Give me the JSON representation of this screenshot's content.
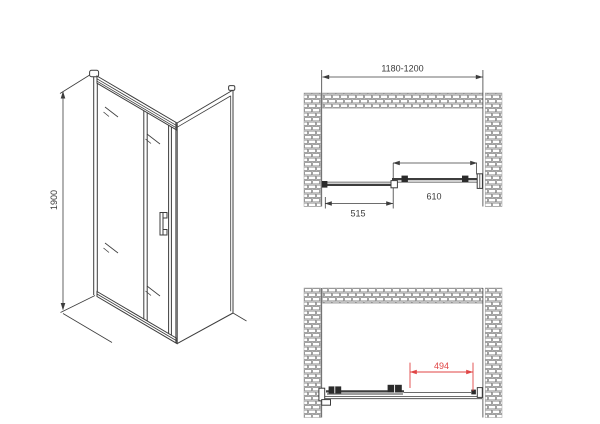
{
  "front": {
    "height_label": "1900"
  },
  "plan_closed": {
    "niche_width_label": "1180-1200",
    "fixed_panel_width_label": "515",
    "sliding_panel_width_label": "610"
  },
  "plan_open": {
    "opening_width_label": "494"
  },
  "colors": {
    "line": "#3d3d3d",
    "dimension_red": "#e04545",
    "brick_line": "#7a7a7a",
    "background": "#ffffff"
  }
}
